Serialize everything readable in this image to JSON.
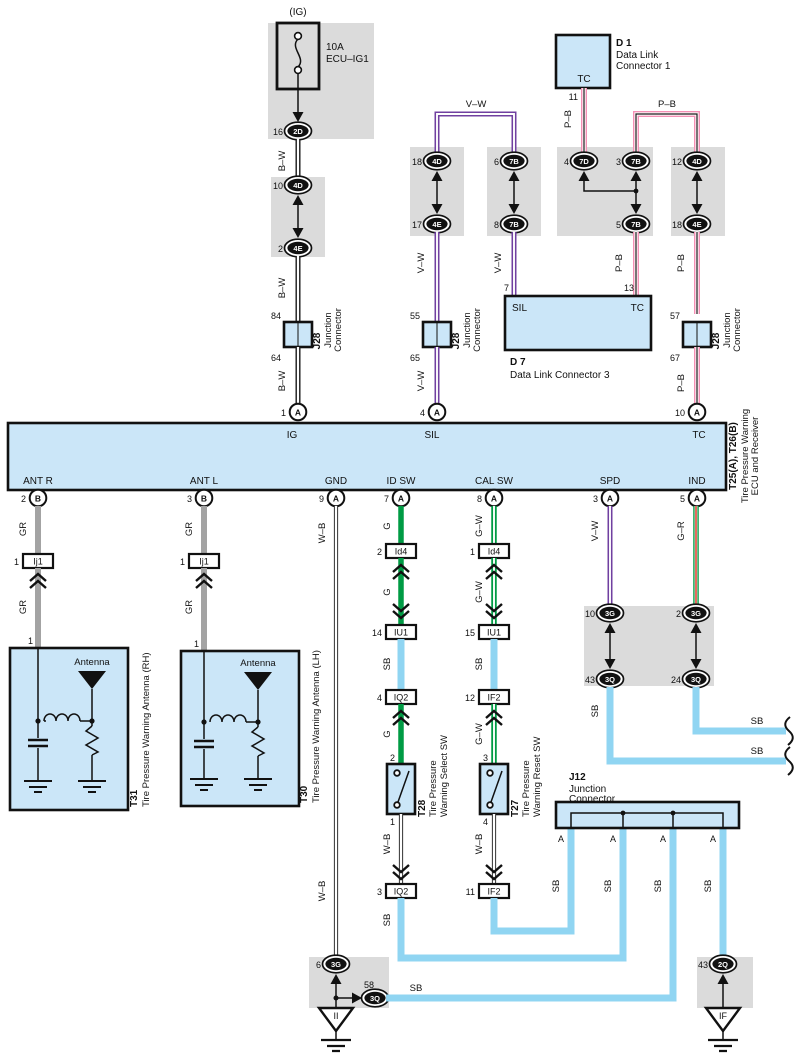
{
  "colors": {
    "component_fill": "#CBE6F8",
    "shield_fill": "#DBDBDB",
    "violet": "#7040A0",
    "pink": "#F590B5",
    "green": "#009B44",
    "gray_wire": "#A3A3A3",
    "sky_blue": "#90D5F2",
    "red": "#DD2B1C"
  },
  "fuse": {
    "tag": "(IG)",
    "rating": "10A",
    "name": "ECU–IG1"
  },
  "wires": {
    "bw": "B–W",
    "vw": "V–W",
    "pb": "P–B",
    "gr": "GR",
    "g": "G",
    "gw": "G–W",
    "g_r": "G–R",
    "sb": "SB",
    "wb": "W–B"
  },
  "conn": {
    "c2d": {
      "pin": "16",
      "id": "2D"
    },
    "c4d_a": {
      "pin": "10",
      "id": "4D"
    },
    "c4e_a": {
      "pin": "2",
      "id": "4E"
    },
    "c4d_b": {
      "pin": "18",
      "id": "4D"
    },
    "c4e_b": {
      "pin": "17",
      "id": "4E"
    },
    "c7b_a": {
      "pin": "6",
      "id": "7B"
    },
    "c7b_b": {
      "pin": "8",
      "id": "7B"
    },
    "c7d": {
      "pin": "4",
      "id": "7D"
    },
    "c7b_c": {
      "pin": "3",
      "id": "7B"
    },
    "c7b_d": {
      "pin": "5",
      "id": "7B"
    },
    "c4d_c": {
      "pin": "12",
      "id": "4D"
    },
    "c4e_c": {
      "pin": "18",
      "id": "4E"
    },
    "c3g_a": {
      "pin": "10",
      "id": "3G"
    },
    "c3q_a": {
      "pin": "43",
      "id": "3Q"
    },
    "c3g_b": {
      "pin": "2",
      "id": "3G"
    },
    "c3q_b": {
      "pin": "24",
      "id": "3Q"
    },
    "c3g_c": {
      "pin": "6",
      "id": "3G"
    },
    "c3q_c": {
      "pin": "58",
      "id": "3Q"
    },
    "c2q": {
      "pin": "43",
      "id": "2Q"
    }
  },
  "j28": {
    "code": "J28",
    "sub1": "Junction",
    "sub2": "Connector",
    "inst1": {
      "top": "84",
      "bottom": "64"
    },
    "inst2": {
      "top": "55",
      "bottom": "65"
    },
    "inst3": {
      "top": "57",
      "bottom": "67"
    }
  },
  "inline": {
    "ij1_r": {
      "pin": "1",
      "id": "Ij1"
    },
    "ij1_l": {
      "pin": "1",
      "id": "Ij1"
    },
    "id4_a": {
      "pin": "2",
      "id": "Id4"
    },
    "id4_b": {
      "pin": "1",
      "id": "Id4"
    },
    "iu1_a": {
      "pin": "14",
      "id": "IU1"
    },
    "iu1_b": {
      "pin": "15",
      "id": "IU1"
    },
    "iq2_a": {
      "pin": "4",
      "id": "IQ2"
    },
    "iq2_b": {
      "pin": "3",
      "id": "IQ2"
    },
    "if2_a": {
      "pin": "12",
      "id": "IF2"
    },
    "if2_b": {
      "pin": "11",
      "id": "IF2"
    }
  },
  "d1": {
    "code": "D 1",
    "name1": "Data Link",
    "name2": "Connector 1",
    "tc": "TC",
    "pin": "11"
  },
  "d7": {
    "code": "D 7",
    "name": "Data Link Connector 3",
    "sil": "SIL",
    "tc": "TC",
    "pin_sil": "7",
    "pin_tc": "13"
  },
  "ecu": {
    "code": "T25(A), T26(B)",
    "name1": "Tire Pressure Warning",
    "name2": "ECU and Receiver",
    "ig": "IG",
    "sil": "SIL",
    "tc": "TC",
    "ant_r": "ANT R",
    "ant_l": "ANT L",
    "gnd": "GND",
    "id_sw": "ID SW",
    "cal_sw": "CAL SW",
    "spd": "SPD",
    "ind": "IND",
    "pins": {
      "ig": {
        "pin": "1",
        "id": "A"
      },
      "sil": {
        "pin": "4",
        "id": "A"
      },
      "tc": {
        "pin": "10",
        "id": "A"
      },
      "ant_r": {
        "pin": "2",
        "id": "B"
      },
      "ant_l": {
        "pin": "3",
        "id": "B"
      },
      "gnd": {
        "pin": "9",
        "id": "A"
      },
      "id_sw": {
        "pin": "7",
        "id": "A"
      },
      "cal_sw": {
        "pin": "8",
        "id": "A"
      },
      "spd": {
        "pin": "3",
        "id": "A"
      },
      "ind": {
        "pin": "5",
        "id": "A"
      }
    }
  },
  "t31": {
    "code": "T31",
    "name": "Tire Pressure Warning Antenna (RH)",
    "pin": "1",
    "antenna": "Antenna"
  },
  "t30": {
    "code": "T30",
    "name": "Tire Pressure Warning Antenna (LH)",
    "pin": "1",
    "antenna": "Antenna"
  },
  "t28": {
    "code": "T28",
    "name1": "Tire Pressure",
    "name2": "Warning Select SW",
    "pin_in": "2",
    "pin_out": "1"
  },
  "t27": {
    "code": "T27",
    "name1": "Tire Pressure",
    "name2": "Warning Reset SW",
    "pin_in": "3",
    "pin_out": "4"
  },
  "j12": {
    "code": "J12",
    "sub1": "Junction",
    "sub2": "Connector",
    "pin": "A"
  },
  "grounds": {
    "g1": "II",
    "g2": "IF"
  }
}
